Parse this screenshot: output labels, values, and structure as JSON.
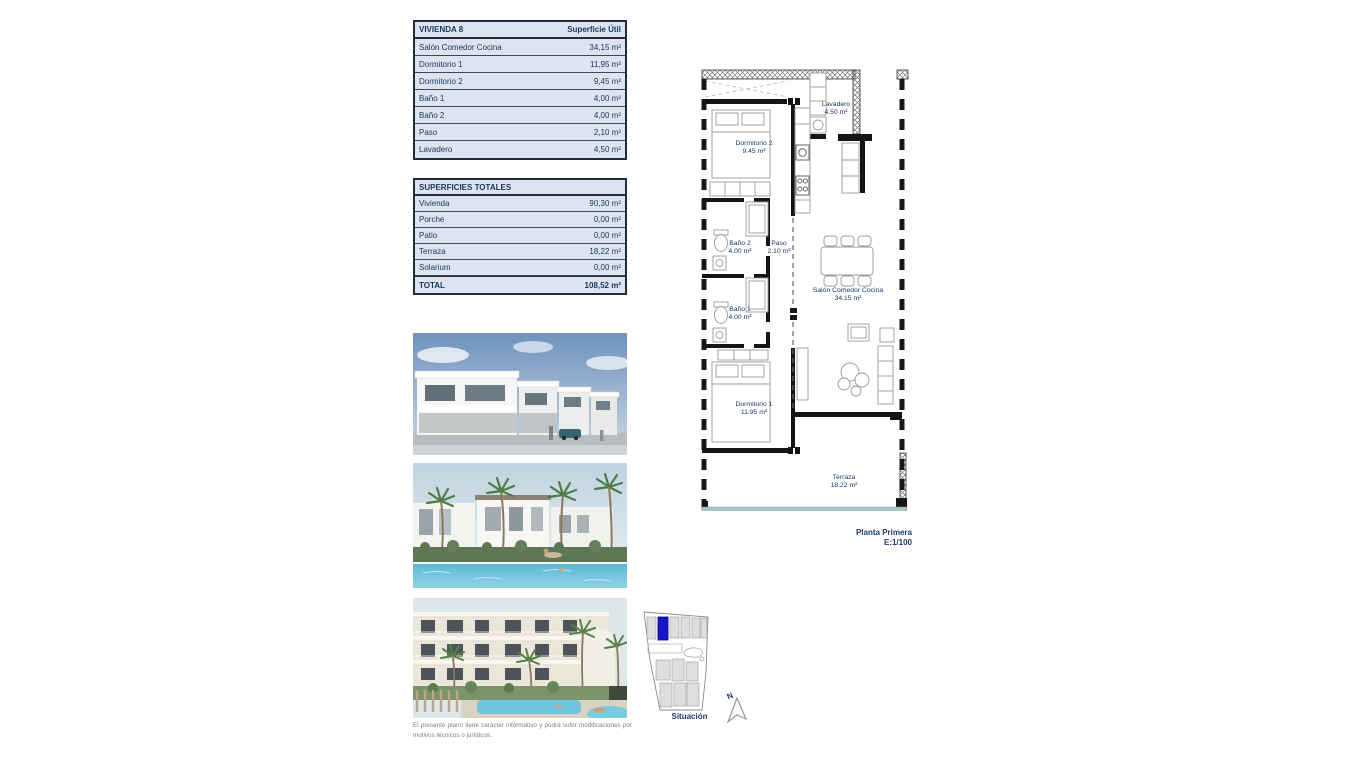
{
  "tables": {
    "vivienda": {
      "title": "VIVIENDA 8",
      "col_header": "Superficie Útil",
      "rows": [
        {
          "label": "Salón Comedor Cocina",
          "value": "34,15 m²"
        },
        {
          "label": "Dormitorio 1",
          "value": "11,95 m²"
        },
        {
          "label": "Dormitorio 2",
          "value": "9,45 m²"
        },
        {
          "label": "Baño 1",
          "value": "4,00 m²"
        },
        {
          "label": "Baño 2",
          "value": "4,00 m²"
        },
        {
          "label": "Paso",
          "value": "2,10 m²"
        },
        {
          "label": "Lavadero",
          "value": "4,50 m²"
        }
      ]
    },
    "superficies": {
      "title": "SUPERFICIES TOTALES",
      "rows": [
        {
          "label": "Vivienda",
          "value": "90,30 m²"
        },
        {
          "label": "Porche",
          "value": "0,00 m²"
        },
        {
          "label": "Patio",
          "value": "0,00 m²"
        },
        {
          "label": "Terraza",
          "value": "18,22 m²"
        },
        {
          "label": "Solarium",
          "value": "0,00 m²"
        }
      ],
      "total": {
        "label": "TOTAL",
        "value": "108,52 m²"
      }
    }
  },
  "floorplan": {
    "rooms": [
      {
        "name": "Lavadero",
        "area": "4.50 m²"
      },
      {
        "name": "Dormitorio 2",
        "area": "9.45 m²"
      },
      {
        "name": "Baño 2",
        "area": "4.00 m²"
      },
      {
        "name": "Paso",
        "area": "2.10 m²"
      },
      {
        "name": "Baño 1",
        "area": "4.00 m²"
      },
      {
        "name": "Salón Comedor Cocina",
        "area": "34.15 m²"
      },
      {
        "name": "Dormitorio 1",
        "area": "11.95 m²"
      },
      {
        "name": "Terraza",
        "area": "18.22 m²"
      }
    ],
    "caption_line1": "Planta Primera",
    "caption_line2": "E:1/100"
  },
  "sitemap": {
    "label": "Situación",
    "north_letter": "N",
    "highlight_color": "#1617cd"
  },
  "disclaimer": "El presente plano tiene carácter informativo y podrá sufrir modificaciones por motivos técnicos o jurídicos.",
  "colors": {
    "table_bg": "#dde4f0",
    "navy": "#17365d",
    "wall": "#151515",
    "terrace_line": "#a7c6c6"
  }
}
